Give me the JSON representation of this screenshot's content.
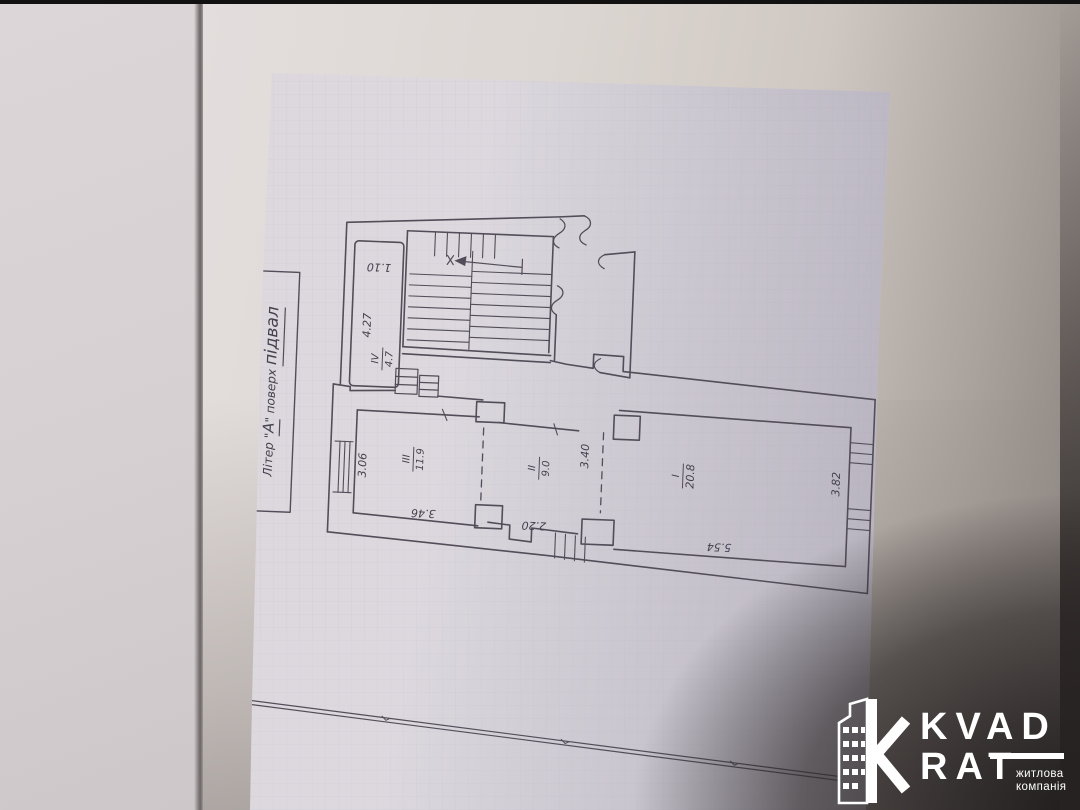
{
  "stamp": {
    "segments": [
      "Літер \"",
      "А",
      "\" поверх ",
      "підвал"
    ]
  },
  "plan": {
    "rooms": [
      {
        "number": "ІV",
        "area": "4.7",
        "dim_a": "4.27",
        "dim_b": "1.10"
      },
      {
        "number": "ІІІ",
        "area": "11.9",
        "dim_a": "3.46",
        "dim_b": "3.06"
      },
      {
        "number": "ІІ",
        "area": "9.0",
        "dim_a": "2.20",
        "dim_b": "3.40"
      },
      {
        "number": "І",
        "area": "20.8",
        "dim_a": "5.54",
        "dim_b": "3.82"
      }
    ]
  },
  "logo": {
    "brand_top": "KVAD",
    "brand_bottom": "RAT",
    "tagline_top": "житлова",
    "tagline_bottom": "компанія"
  },
  "colors": {
    "paper": "#dcd8de",
    "ink": "#524d58",
    "shadow": "#2a2626",
    "logo_text": "#ffffff"
  }
}
